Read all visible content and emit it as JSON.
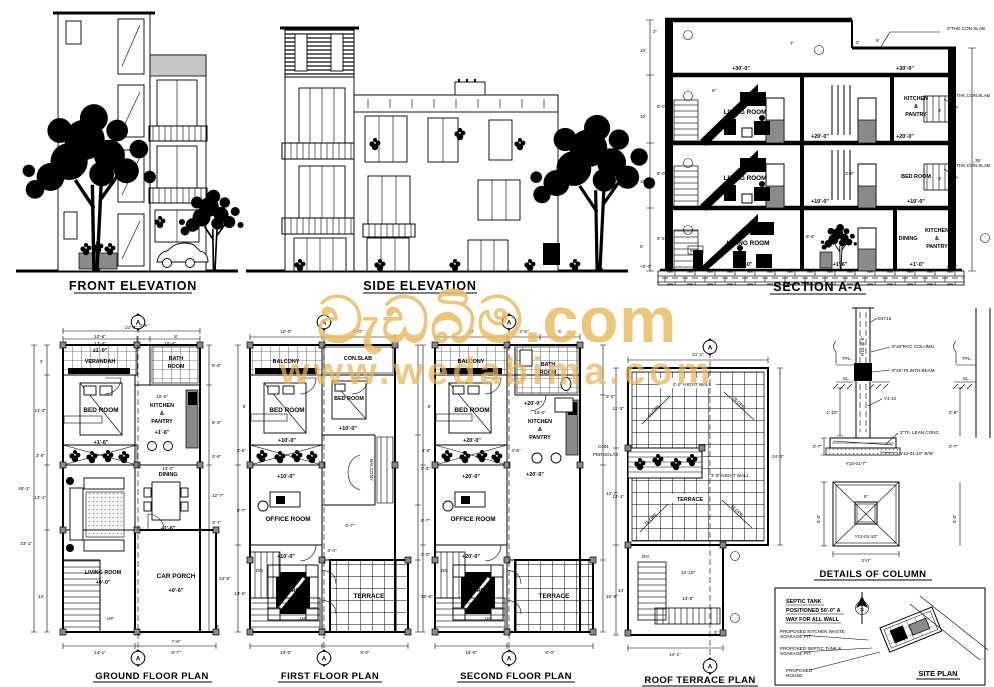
{
  "watermark": {
    "line1": "වැඩබිම.com",
    "line2": "www.wedabima.com",
    "color": "#E9BC61"
  },
  "marker_a": "A",
  "colors": {
    "ink": "#000000",
    "door_fill": "#8a8a8a",
    "column_marker": "#8a8a8a",
    "watermark": "#E9BC61"
  },
  "elevations": {
    "front_title": "FRONT ELEVATION",
    "side_title": "SIDE ELEVATION"
  },
  "section": {
    "title": "SECTION A-A",
    "slab_note": "5\"THK.CON.SLAB",
    "living": "LIVING ROOM",
    "bed": "BED ROOM",
    "dining": "DINING",
    "kitchen_lines": [
      "KITCHEN",
      "&",
      "PANTRY"
    ],
    "lv30": "+30'-0\"",
    "lv20": "+20'-0\"",
    "lv10": "+10'-0\"",
    "lv1_0": "+1'-0\"",
    "lv1_6": "+1'-6\"",
    "lv0": "+0'-0\"",
    "dims": {
      "d2in": "2\"",
      "d10": "10'",
      "d8": "8'-0\"",
      "d9_2": "9'-2\"",
      "d35": "35'",
      "d3": "3'",
      "d5": "5'",
      "d7": "7'",
      "d2": "2'",
      "d8_6": "8'-6\"",
      "d3_5": "3'-5\"",
      "d5_6": "5'-6\"",
      "d6in": "6\""
    }
  },
  "gf": {
    "title": "GROUND FLOOR PLAN",
    "verandah": "VERANDAH",
    "bed": "BED ROOM",
    "bath_lines": [
      "BATH",
      "ROOM"
    ],
    "kitchen_lines": [
      "KITCHEN",
      "&",
      "PANTRY"
    ],
    "dining": "DINING",
    "living": "LIVING ROOM",
    "car_porch": "CAR PORCH",
    "up": "UP",
    "lv1_0": "±1'-0\"",
    "lv1_6": "+1'-6\"",
    "lv0": "+0'-0\"",
    "lv0_6": "+0'-6\"",
    "dims": {
      "top_total": "21'-6\"",
      "t1": "10'-6\"",
      "t2": "3'-5\"",
      "t3": "8'",
      "t4": "13'-4\"",
      "t5": "10'-4\"",
      "l_total": "45'-1\"",
      "l1": "4'",
      "l2": "11'-3\"",
      "l3": "3'-6\"",
      "l4": "13'-1\"",
      "l5": "23'-1\"",
      "l6": "14'",
      "r1": "5'-5\"",
      "r2": "8'-3\"",
      "r3": "3'-6\"",
      "r4": "12'-7\"",
      "r5": "3'-7\"",
      "r6": "13'-5\"",
      "r7": "2'",
      "b1": "14'-1\"",
      "b2": "7'-6\"",
      "b3": "8'-7\"",
      "i1": "10'-0\"",
      "i2": "13'-2\""
    }
  },
  "ff": {
    "title": "FIRST FLOOR PLAN",
    "balcony": "BALCONY",
    "conslab": "CON.SLAB",
    "bed1": "BED ROOM",
    "bed2": "BED ROOM",
    "balcony_v": "BALCONY",
    "office": "OFFICE ROOM",
    "room": "ROOM",
    "terrace": "TERRACE",
    "dn": "DN",
    "up": "UP",
    "lv": "+10'-0\"",
    "dims": {
      "t1": "10'-0\"",
      "b1": "13'-0\"",
      "b2": "8'-0\"",
      "r1": "5'-4\"",
      "r2": "8'-7\"",
      "r3": "2'-0\"",
      "r4": "15'-8\"",
      "l1": "8'",
      "l2": "3'-6\"",
      "l3": "8'-7\"",
      "l4": "13'-5\"",
      "i1": "8'-0\"",
      "i2": "5'-7\"",
      "i3": "3'-4\""
    }
  },
  "sf": {
    "title": "SECOND FLOOR PLAN",
    "balcony": "BALCONY",
    "bed": "BED ROOM",
    "bath_lines": [
      "BATH",
      "ROOM"
    ],
    "kitchen_lines": [
      "KITCHEN",
      "&",
      "PANTRY"
    ],
    "kw": "10'-0\"",
    "office": "OFFICE ROOM",
    "room": "ROOM",
    "terrace": "TERRACE",
    "pergolas_lines": [
      "CON.",
      "PERGOLAS"
    ],
    "dn": "DN",
    "up": "UP",
    "lv": "+20'-0\"",
    "dims": {
      "t1": "10'",
      "t2": "3'-5\"",
      "t3": "5'",
      "b1": "13'-0\"",
      "b2": "8'-0\"",
      "r1": "3'-5\"",
      "r2": "12'-7\"",
      "r3": "15'-8\"",
      "l1": "8'",
      "l2": "3'-6\"",
      "i1": "4'-6\""
    }
  },
  "roof": {
    "title": "ROOF TERRACE PLAN",
    "wall2": "2'-0\" HIGHT WALL",
    "wall3": "3'-0\" HIGHT WALL",
    "slope": "SLOPE",
    "terrace": "TERRACE",
    "dn": "DN",
    "dims": {
      "t1": "21'-1\"",
      "r1": "24'-3\"",
      "l1": "11'-3\"",
      "l2": "13'-1\"",
      "l3": "14'",
      "b1": "14'-1\"",
      "i1": "13'-10\"",
      "i2": "13'-5\"",
      "i3": "3'"
    }
  },
  "column": {
    "title": "DETAILS OF COLUMN",
    "bars": "04Y16",
    "stirrups": "R10 @ 6\"",
    "rcc": "9\"x9\"RCC COLUMN",
    "plinth": "9\"x9\" PLINTH BEAM",
    "y412": "Y4 12",
    "lean": "2\"Th. LEAN CONC.",
    "bw": "Y12-01-10\" B/W",
    "y10": "Y10-01-7\"",
    "y12": "Y12-01-10\"",
    "ffl": "FFL.",
    "gl": "GL.",
    "d1": "1'-10\"",
    "d2": "2'-7\"",
    "d3": "3'-0\"",
    "d4": "3'-0\"",
    "d5": "2'-6\"",
    "d9": "9\""
  },
  "site": {
    "title": "SITE PLAN",
    "note1": "SEPTIC TANK",
    "note2": "POSITIONED 50'-0\" A",
    "note3": "WAY FOR ALL WALL",
    "lbl1a": "PROPOSED KITCHEN WASTE",
    "lbl1b": "SOAKAGE PIT",
    "lbl2a": "PROPOSED SEPTIC TANK &",
    "lbl2b": "SOAKAGE PIT",
    "lbl3a": "PROPOSED",
    "lbl3b": "HOUSE",
    "north": "N"
  }
}
